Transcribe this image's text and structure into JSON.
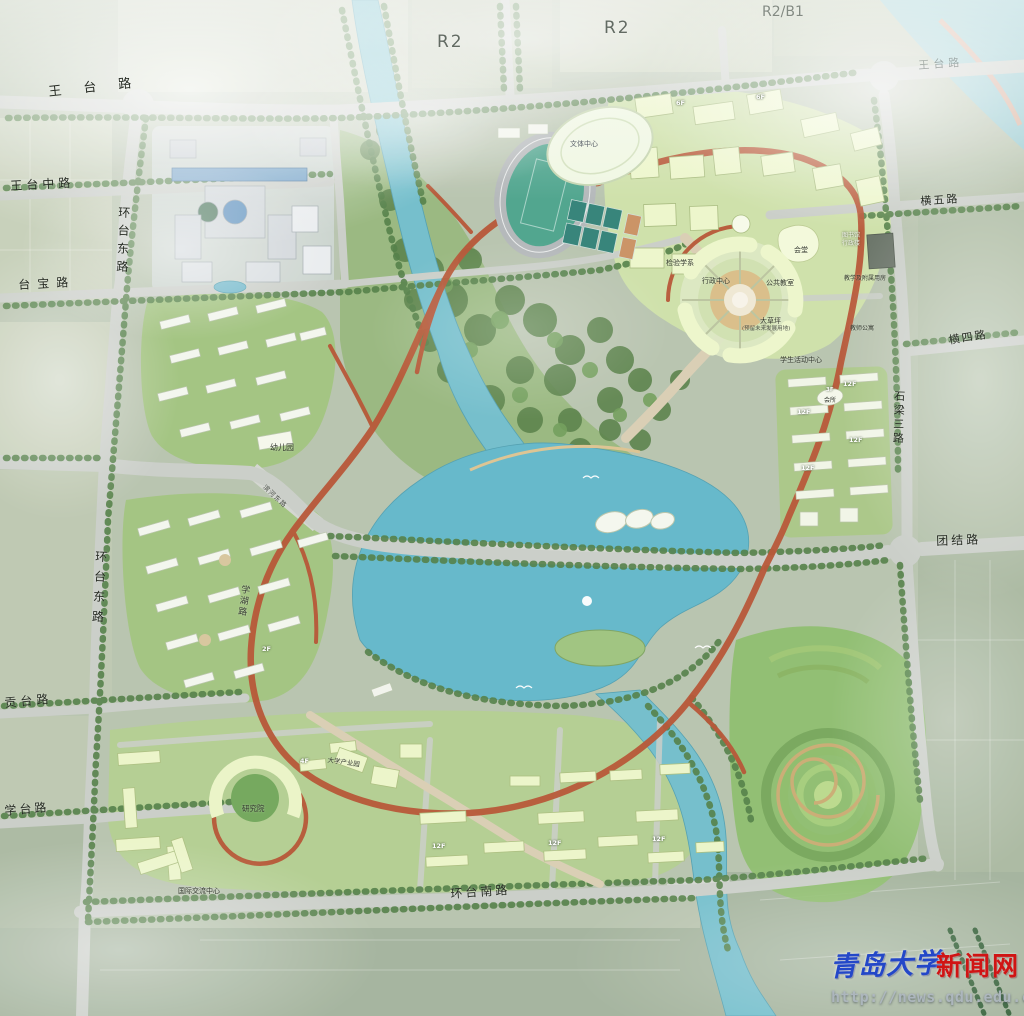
{
  "zones": {
    "r2_west": "R2",
    "r2_east": "R2",
    "r2b1": "R2/B1",
    "wangtai_ghost": "王台路"
  },
  "roads": {
    "wangtai": "王台路",
    "wangtai_zhong": "王台中路",
    "huantai_dong_north": "环台东路",
    "taibao": "台宝路",
    "huantai_dong_south": "环台东路",
    "gongtai": "贡台路",
    "xuetai": "学台路",
    "hengwu": "横五路",
    "hengsi": "横四路",
    "shiliang_san": "石梁三路",
    "tuanjie": "团结路",
    "huantai_nan": "环台南路",
    "xuehu": "学湖路",
    "binhe": "滨河东路"
  },
  "facilities": {
    "sports_center": "文体中心",
    "auditorium": "会堂",
    "library": "图书馆",
    "admin_building": "行政楼",
    "public_classrooms": "公共教室",
    "admin_center": "行政中心",
    "departments": "检验学系",
    "teaching_annex": "教学及附属用房",
    "great_lawn": "大草坪",
    "great_lawn_note": "(预留未来发展用地)",
    "student_center": "学生活动中心",
    "faculty_apartments": "教师公寓",
    "clubhouse": "会所",
    "kindergarten": "幼儿园",
    "research_institute": "研究院",
    "intl_exchange_center": "国际交流中心",
    "university_industry": "大学产业园"
  },
  "floor_tags": [
    "12F",
    "12F",
    "12F",
    "12F",
    "3F",
    "12F",
    "12F",
    "12F",
    "6F",
    "6F",
    "4F",
    "2F"
  ],
  "watermark": {
    "site_name": "青岛大学",
    "site_suffix": "新闻网",
    "url": "http://news.qdu.edu.cn"
  },
  "colors": {
    "water": "#6fbcca",
    "road": "#c9cdc7",
    "loop_road": "#b5502f",
    "campus_green": "#a8c983",
    "forest": "#557e44",
    "building": "#ecf6c8",
    "watermark_blue": "#2347c8",
    "watermark_red": "#d01414"
  }
}
